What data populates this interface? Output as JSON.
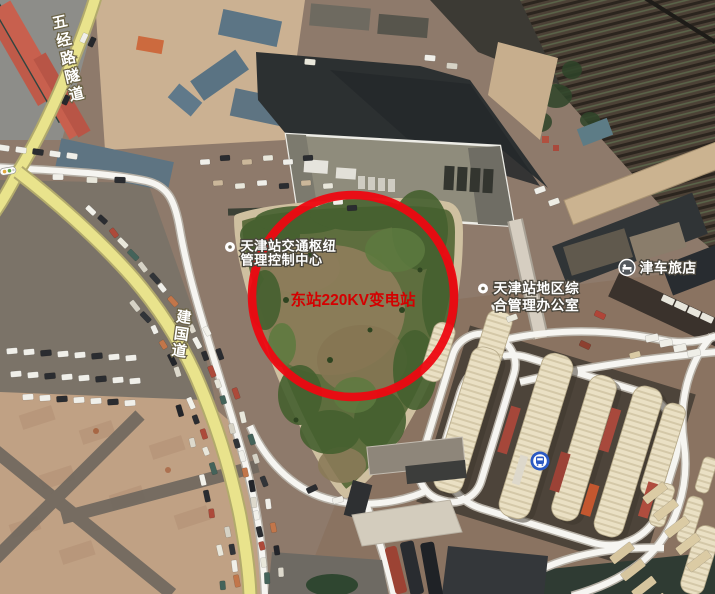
{
  "map": {
    "road_labels": [
      {
        "id": "wujing-tunnel",
        "text": "五经路隧道"
      },
      {
        "id": "jianguo-road",
        "text": "建国道"
      }
    ],
    "pois": [
      {
        "id": "control-center",
        "line1": "天津站交通枢纽",
        "line2": "管理控制中心"
      },
      {
        "id": "admin-office",
        "line1": "天津站地区综",
        "line2": "合管理办公室"
      },
      {
        "id": "hotel",
        "name": "津车旅店"
      }
    ],
    "annotation": {
      "label": "东站220KV变电站",
      "shape": "circle"
    },
    "colors": {
      "annotation_red": "#ee0711",
      "annotation_text_red": "#d40000",
      "road_yellow": "#e9e38c",
      "road_yellow_casing": "#b2aa6c",
      "road_white": "#f6f5f1",
      "transit_blue": "#2b59c3",
      "greenfield": "#5e6e3e"
    }
  }
}
